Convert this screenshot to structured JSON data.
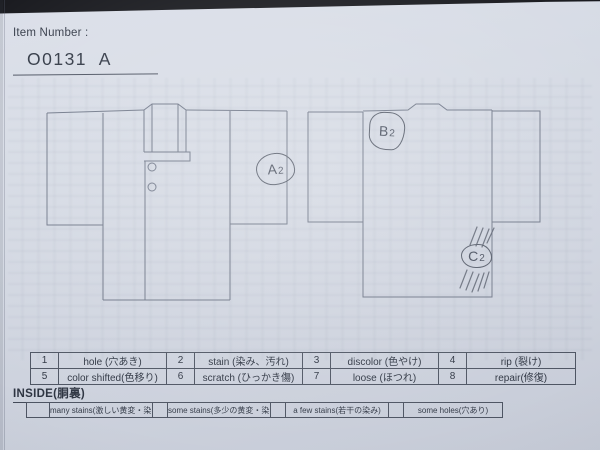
{
  "header": {
    "label": "Item Number :",
    "item_number": "O0131  A"
  },
  "annotations": {
    "a2": {
      "letter": "A",
      "sub": "2"
    },
    "b2": {
      "letter": "B",
      "sub": "2"
    },
    "c2": {
      "letter": "C",
      "sub": "2"
    }
  },
  "defect_codes": [
    {
      "num": "1",
      "label": "hole (穴あき)"
    },
    {
      "num": "2",
      "label": "stain (染み、汚れ)"
    },
    {
      "num": "3",
      "label": "discolor (色やけ)"
    },
    {
      "num": "4",
      "label": "rip (裂け)"
    },
    {
      "num": "5",
      "label": "color shifted(色移り)"
    },
    {
      "num": "6",
      "label": "scratch (ひっかき傷)"
    },
    {
      "num": "7",
      "label": "loose (ほつれ)"
    },
    {
      "num": "8",
      "label": "repair(修復)"
    }
  ],
  "inside": {
    "title": "INSIDE(胴裏)",
    "options": [
      "many stains(激しい黄変・染み)",
      "some stains(多少の黄変・染み)",
      "a few stains(若干の染み)",
      "some holes(穴あり)"
    ]
  },
  "colors": {
    "paper": "#d3d8e2",
    "ink": "#2f3643",
    "print_line": "#6e7687",
    "pencil": "#535a68",
    "photo_background": "#16171c"
  }
}
